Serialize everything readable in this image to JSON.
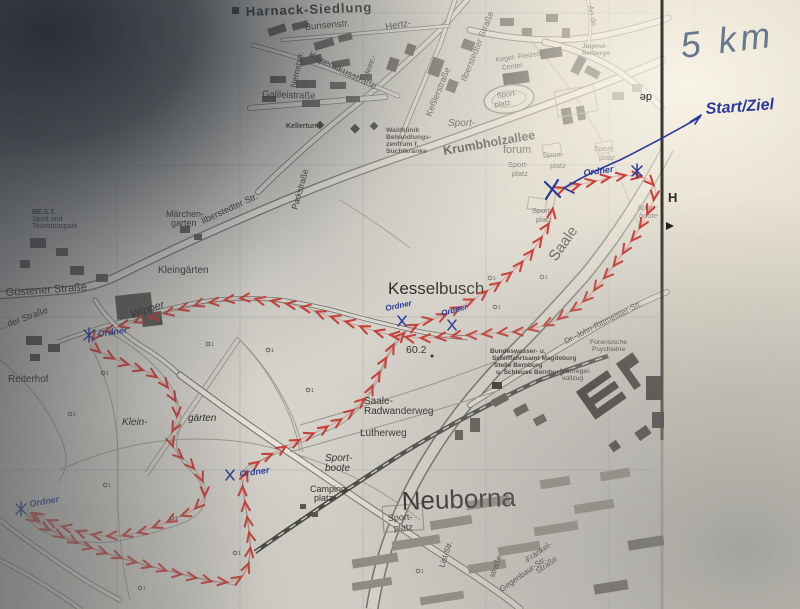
{
  "annotations": {
    "distance": "5 km",
    "start_finish": "Start/Ziel",
    "marshal": "Ordner",
    "pen_color": "#2b3a96",
    "marker_color": "#67788c",
    "route_color": "#c5302c"
  },
  "places": {
    "harnack": "Harnack-Siedlung",
    "kesselbusch": "Kesselbusch",
    "neuborna": "Neuborna",
    "maerchen_l1": "Märchen-",
    "maerchen_l2": "garten",
    "kleingaerten": "Kleingärten",
    "klein_l1": "Klein-",
    "klein_l2": "gärten",
    "reiterhof": "Reiterhof",
    "best_l1": "BE.S.T.",
    "best_l2": "Sport und",
    "best_l3": "Tourismuspark",
    "forum": "forum",
    "jugend_l1": "Jugend-",
    "jugend_l2": "herberge",
    "kegel_l1": "Kegel- Freizeit-",
    "kegel_l2": "Center",
    "kellerturm": "Kellerturm",
    "waldklinik_l1": "Waldklinik",
    "waldklinik_l2": "Behandlungs-",
    "waldklinik_l3": "zentrum f.",
    "waldklinik_l4": "Suchtkranke",
    "forensische_l1": "Forensische",
    "forensische_l2": "Psychiatrie",
    "massregel_l1": "Maßregel-",
    "massregel_l2": "vollzug",
    "bwsa_l1": "Bundeswasser- u.",
    "bwsa_l2": "Schifffahrtsamt Magdeburg",
    "bwsa_l3": "Stelle Bernburg",
    "bwsa_l4": "u. Schleuse Bernburg",
    "camping_l1": "Camping-",
    "camping_l2": "platz",
    "elevation": "60.2",
    "bus_stop": "H",
    "edge_label": "de"
  },
  "streets": {
    "bunsen": "Bunsenstr.",
    "hertz": "Hertz-",
    "heinr": "Heinr.-",
    "nernst": "Nernststr.",
    "kopernikus": "Kopernikusstraße",
    "galilei": "Galileistraße",
    "ilberstedter": "Ilberstedter Straße",
    "ilberstedter2": "Ilberstedter Str.",
    "kessler": "Keßlerstraße",
    "an_de": "An de",
    "park": "Parkstraße",
    "krumbholz": "Krumbholzallee",
    "guestener": "Güstener Straße",
    "eder": "…der Straße",
    "drjohn": "Dr.-John-Rittmeister-Str.",
    "list": "List-Str.",
    "strasse_frag": "straße",
    "fraenkel_l1": "-Fränkel-",
    "fraenkel_l2": "Straße",
    "gegenbaur": "Gegenbaur-Str."
  },
  "waters": {
    "saale": "Saale",
    "wipper": "Wipper"
  },
  "paths": {
    "radweg_l1": "Saale-",
    "radweg_l2": "Radwanderweg",
    "lutherweg": "Lutherweg"
  },
  "sports": {
    "sport": "Sport-",
    "platz": "platz",
    "boote": "boote"
  },
  "symbols": {
    "benchmark": "1"
  }
}
